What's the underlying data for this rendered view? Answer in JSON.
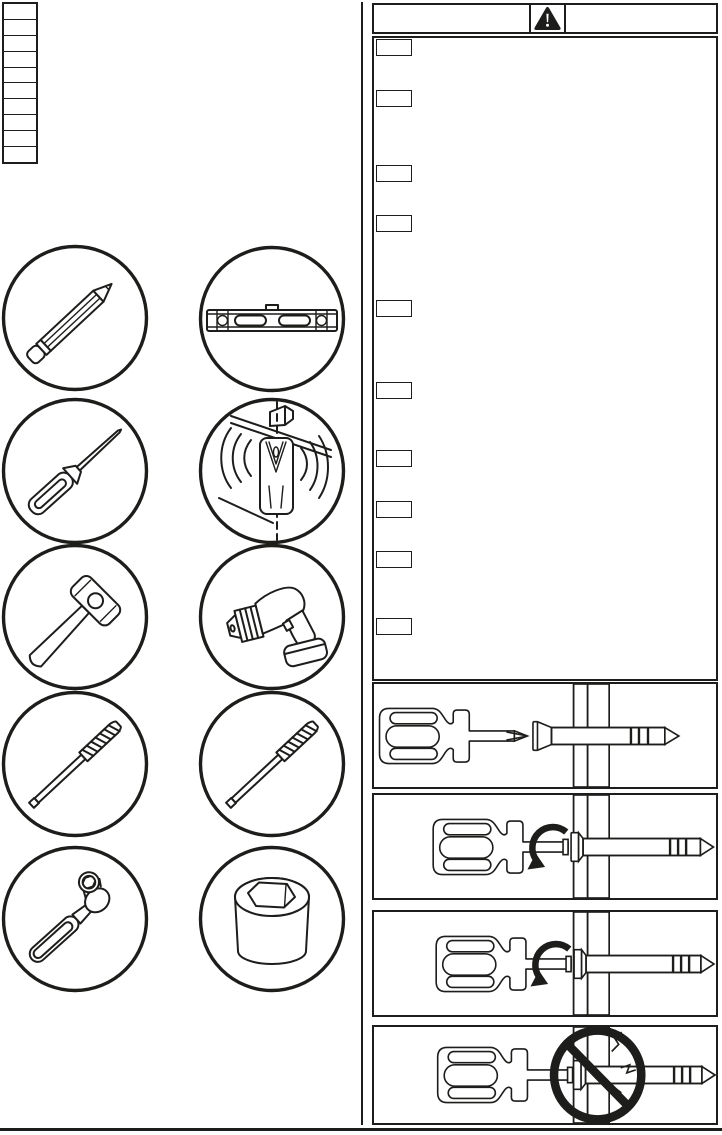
{
  "page": {
    "background": "#ffffff",
    "ink": "#1d1d1b"
  },
  "language_table": {
    "rows": [
      "",
      "",
      "",
      "",
      "",
      "",
      "",
      "",
      "",
      ""
    ]
  },
  "tools": {
    "items": [
      {
        "icon": "pencil-icon"
      },
      {
        "icon": "spirit-level-icon"
      },
      {
        "icon": "awl-icon"
      },
      {
        "icon": "stud-finder-icon"
      },
      {
        "icon": "hammer-icon"
      },
      {
        "icon": "power-drill-icon"
      },
      {
        "icon": "drill-bit-icon"
      },
      {
        "icon": "drill-bit-icon"
      },
      {
        "icon": "ratchet-wrench-icon"
      },
      {
        "icon": "hex-socket-icon"
      }
    ]
  },
  "warning_panel": {
    "header": {
      "icon": "warning-triangle-icon",
      "left_label": "",
      "right_label": ""
    },
    "note_labels": [
      "",
      "",
      "",
      "",
      "",
      "",
      "",
      "",
      "",
      ""
    ]
  },
  "steps": [
    {
      "icon": "position-screw-with-screwdriver-illustration"
    },
    {
      "icon": "drive-screw-into-wall-illustration"
    },
    {
      "icon": "drive-screw-flush-illustration"
    },
    {
      "icon": "do-not-overtighten-screw-illustration"
    }
  ]
}
